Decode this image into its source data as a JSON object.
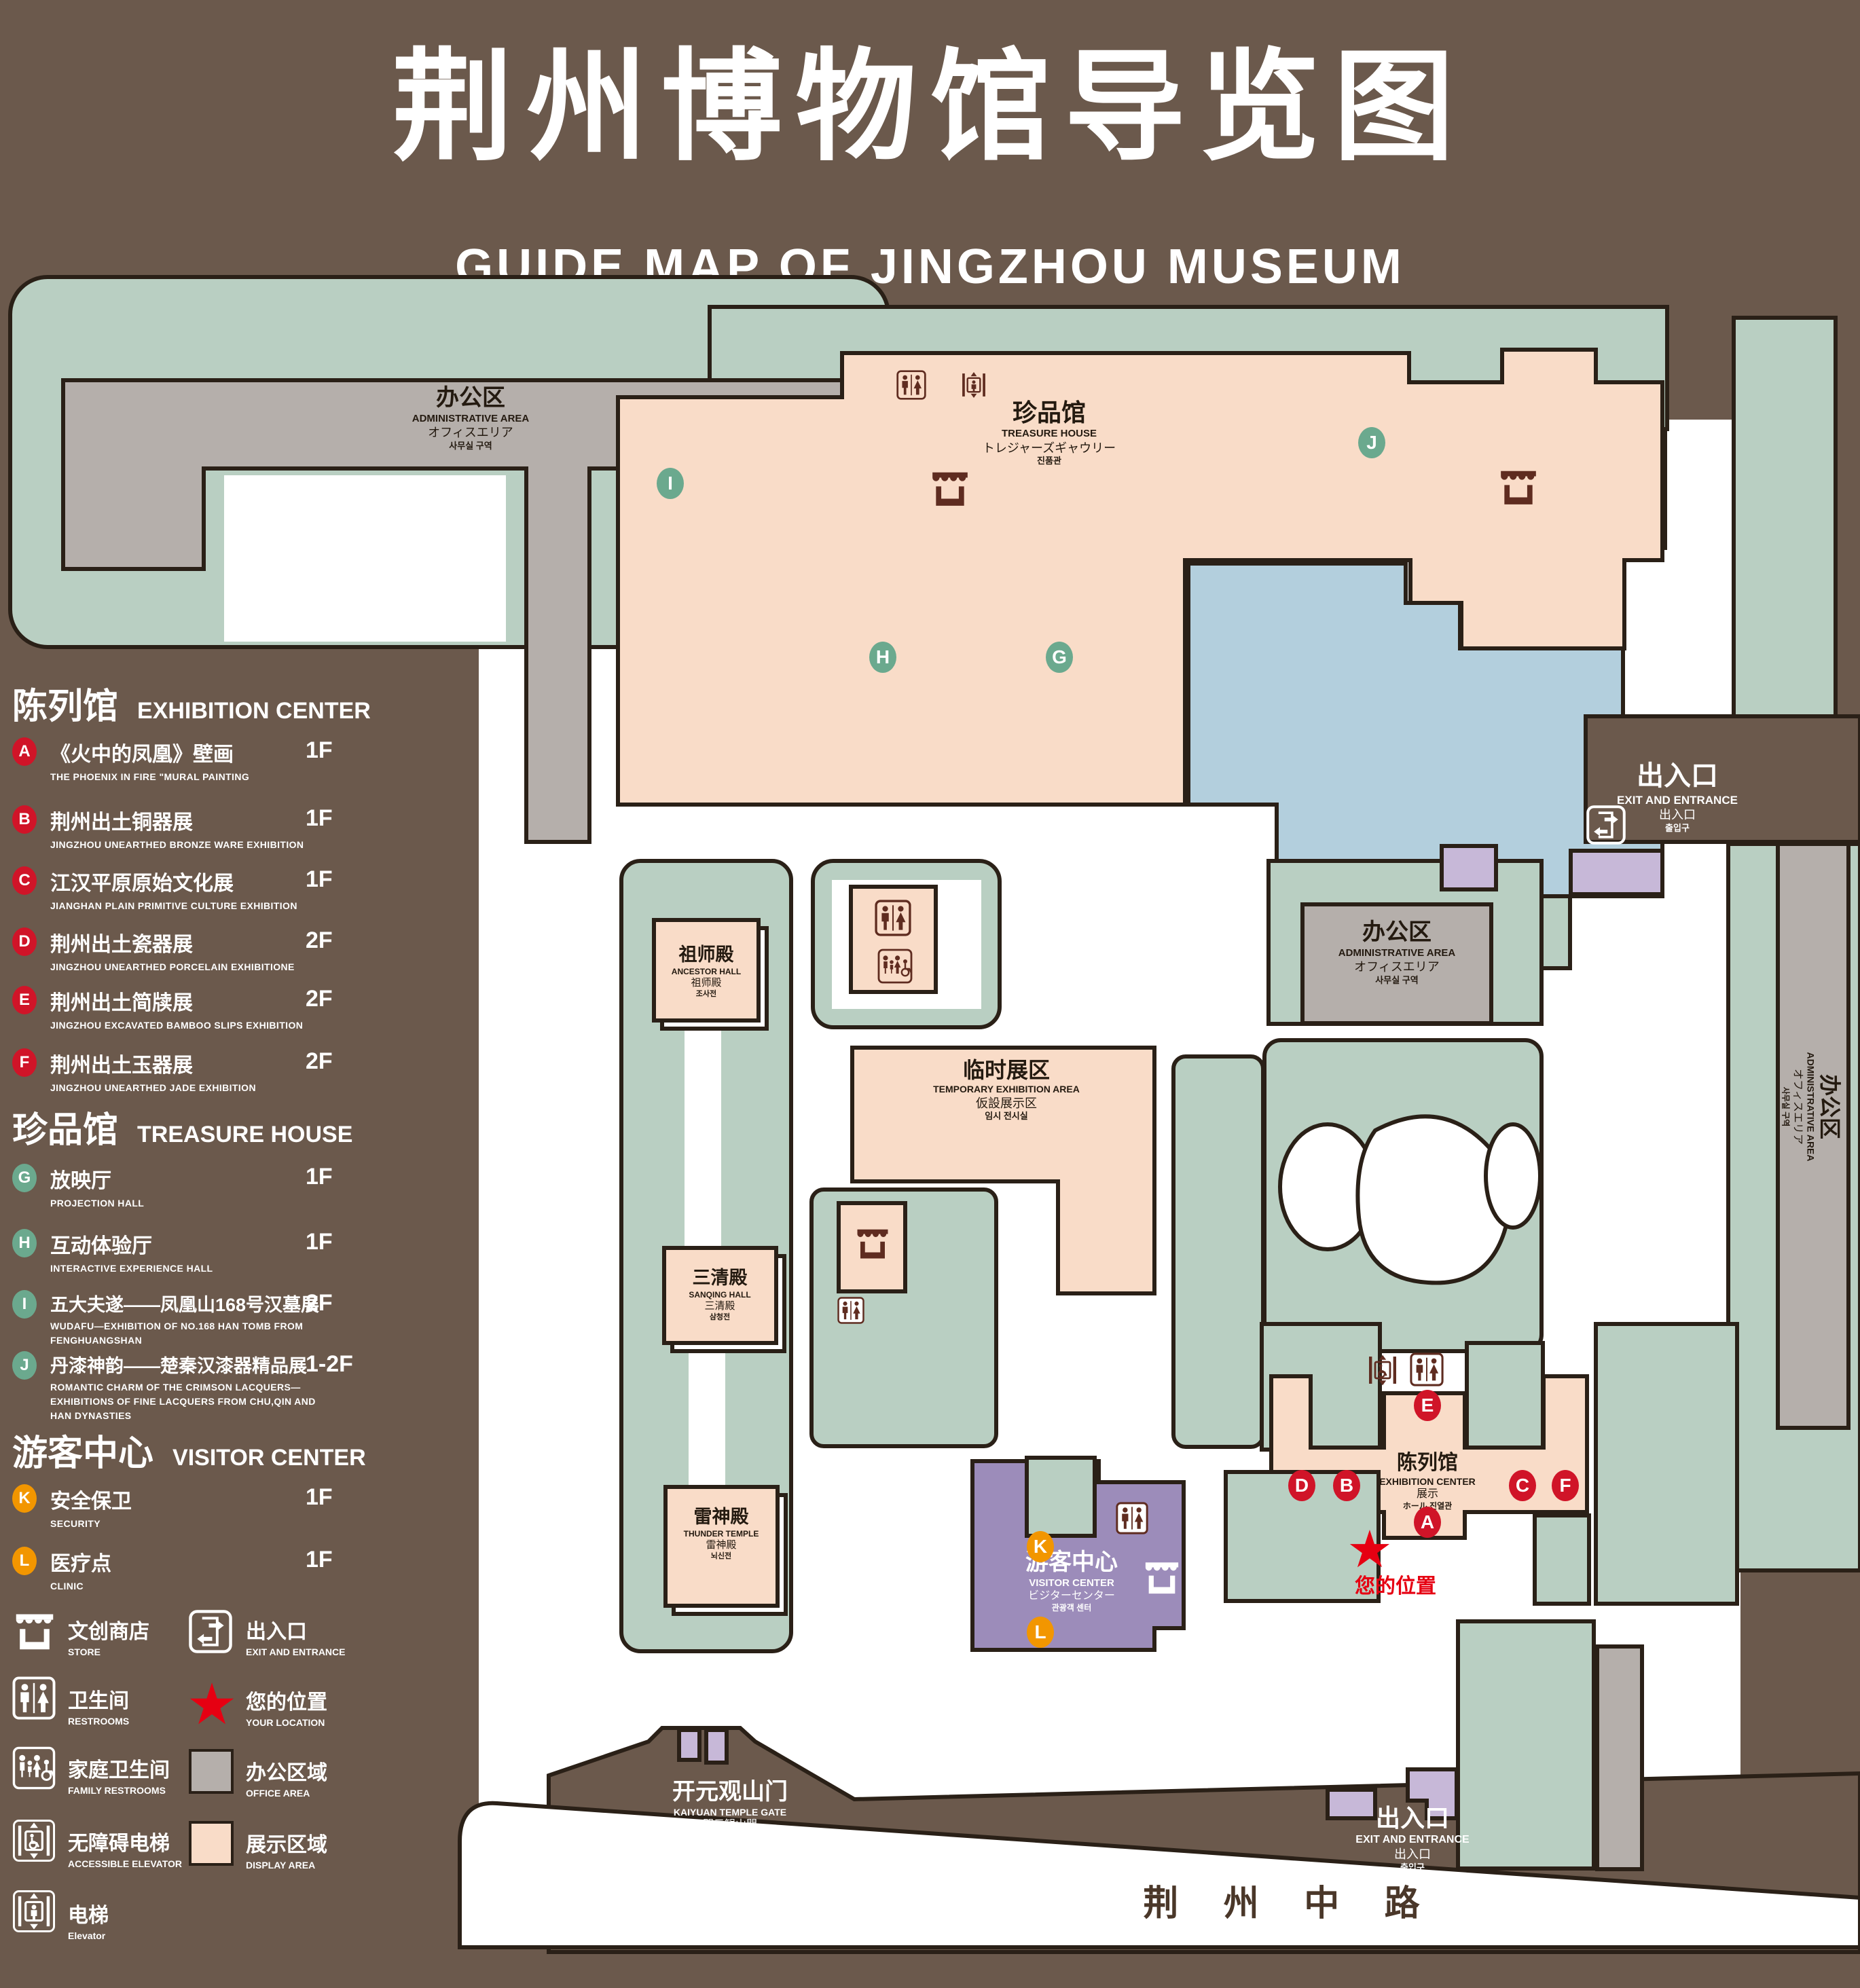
{
  "title": {
    "zh": "荆州博物馆导览图",
    "en": "GUIDE MAP OF JINGZHOU MUSEUM"
  },
  "legend": {
    "sections": [
      {
        "zh": "陈列馆",
        "en": "EXHIBITION CENTER",
        "badge_color": "#d01428",
        "items": [
          {
            "letter": "A",
            "zh": "《火中的凤凰》壁画",
            "en": "THE PHOENIX IN FIRE \"MURAL PAINTING",
            "floor": "1F"
          },
          {
            "letter": "B",
            "zh": "荆州出土铜器展",
            "en": "JINGZHOU UNEARTHED BRONZE WARE EXHIBITION",
            "floor": "1F"
          },
          {
            "letter": "C",
            "zh": "江汉平原原始文化展",
            "en": "JIANGHAN PLAIN PRIMITIVE CULTURE EXHIBITION",
            "floor": "1F"
          },
          {
            "letter": "D",
            "zh": "荆州出土瓷器展",
            "en": "JINGZHOU UNEARTHED PORCELAIN EXHIBITIONE",
            "floor": "2F"
          },
          {
            "letter": "E",
            "zh": "荆州出土简牍展",
            "en": "JINGZHOU EXCAVATED BAMBOO SLIPS EXHIBITION",
            "floor": "2F"
          },
          {
            "letter": "F",
            "zh": "荆州出土玉器展",
            "en": "JINGZHOU UNEARTHED JADE EXHIBITION",
            "floor": "2F"
          }
        ]
      },
      {
        "zh": "珍品馆",
        "en": "TREASURE HOUSE",
        "badge_color": "#6ba98e",
        "items": [
          {
            "letter": "G",
            "zh": "放映厅",
            "en": "PROJECTION HALL",
            "floor": "1F"
          },
          {
            "letter": "H",
            "zh": "互动体验厅",
            "en": "INTERACTIVE EXPERIENCE HALL",
            "floor": "1F"
          },
          {
            "letter": "I",
            "zh": "五大夫遂——凤凰山168号汉墓展",
            "en": "WUDAFU—EXHIBITION OF NO.168 HAN TOMB FROM FENGHUANGSHAN",
            "floor": "2F"
          },
          {
            "letter": "J",
            "zh": "丹漆神韵——楚秦汉漆器精品展",
            "en": "ROMANTIC CHARM OF THE CRIMSON LACQUERS—EXHIBITIONS OF FINE LACQUERS FROM CHU,QIN AND HAN DYNASTIES",
            "floor": "1-2F"
          }
        ]
      },
      {
        "zh": "游客中心",
        "en": "VISITOR CENTER",
        "badge_color": "#f29600",
        "items": [
          {
            "letter": "K",
            "zh": "安全保卫",
            "en": "SECURITY",
            "floor": "1F"
          },
          {
            "letter": "L",
            "zh": "医疗点",
            "en": "CLINIC",
            "floor": "1F"
          }
        ]
      }
    ],
    "symbols": {
      "store": {
        "zh": "文创商店",
        "en": "STORE"
      },
      "restrooms": {
        "zh": "卫生间",
        "en": "RESTROOMS"
      },
      "family_restrooms": {
        "zh": "家庭卫生间",
        "en": "FAMILY RESTROOMS"
      },
      "accessible_elevator": {
        "zh": "无障碍电梯",
        "en": "ACCESSIBLE ELEVATOR"
      },
      "elevator": {
        "zh": "电梯",
        "en": "Elevator"
      },
      "exit": {
        "zh": "出入口",
        "en": "EXIT AND ENTRANCE"
      },
      "your_location": {
        "zh": "您的位置",
        "en": "YOUR LOCATION"
      },
      "office_area": {
        "zh": "办公区域",
        "en": "OFFICE AREA"
      },
      "display_area": {
        "zh": "展示区域",
        "en": "DISPLAY AREA"
      }
    }
  },
  "map": {
    "admin_nw": {
      "zh": "办公区",
      "en": "ADMINISTRATIVE AREA",
      "ja": "オフィスエリア",
      "ko": "사무실 구역"
    },
    "admin_east": {
      "zh": "办公区",
      "en": "ADMINISTRATIVE AREA",
      "ja": "オフィスエリア",
      "ko": "사무실 구역"
    },
    "admin_far_east": {
      "zh": "办公区",
      "en": "ADMINISTRATIVE AREA",
      "ja": "オフィスエリア",
      "ko": "사무실 구역"
    },
    "treasure_house": {
      "zh": "珍品馆",
      "en": "TREASURE HOUSE",
      "ja": "トレジャーズギャウリー",
      "ko": "진품관"
    },
    "ancestor_hall": {
      "zh": "祖师殿",
      "en": "ANCESTOR HALL",
      "ja": "祖师殿",
      "ko": "조사전"
    },
    "temporary_exhibition": {
      "zh": "临时展区",
      "en": "TEMPORARY EXHIBITION AREA",
      "ja": "仮設展示区",
      "ko": "임시 전시실"
    },
    "sanqing_hall": {
      "zh": "三清殿",
      "en": "SANQING HALL",
      "ja": "三清殿",
      "ko": "삼청전"
    },
    "thunder_temple": {
      "zh": "雷神殿",
      "en": "THUNDER TEMPLE",
      "ja": "雷神殿",
      "ko": "뇌신전"
    },
    "visitor_center": {
      "zh": "游客中心",
      "en": "VISITOR CENTER",
      "ja": "ビジターセンター",
      "ko": "관광객 센터"
    },
    "exhibition_center": {
      "zh": "陈列馆",
      "en": "EXHIBITION CENTER",
      "ja": "展示",
      "ko": "ホール 진열관"
    },
    "kaiyuan_gate": {
      "zh": "开元观山门",
      "en": "KAIYUAN TEMPLE GATE",
      "ja": "開元観山門",
      "ko": "산문을 열다"
    },
    "exit_ne": {
      "zh": "出入口",
      "en": "EXIT AND ENTRANCE",
      "ja": "出入口",
      "ko": "출입구"
    },
    "exit_south": {
      "zh": "出入口",
      "en": "EXIT AND ENTRANCE",
      "ja": "出入口",
      "ko": "출입구"
    },
    "your_location": "您的位置",
    "road": "荆 州 中 路"
  },
  "colors": {
    "background": "#6b594c",
    "lawn": "#b9cfc2",
    "display_area": "#f9dcc8",
    "office_area": "#b5afab",
    "pond": "#b3cfdd",
    "visitor_center": "#9c8cba",
    "purple_light": "#c7b8d8",
    "outline": "#2a2017",
    "icon_maroon": "#5f2c20",
    "badge_red": "#d01428",
    "badge_green": "#6ba98e",
    "badge_orange": "#f29600",
    "star_red": "#e60012"
  }
}
